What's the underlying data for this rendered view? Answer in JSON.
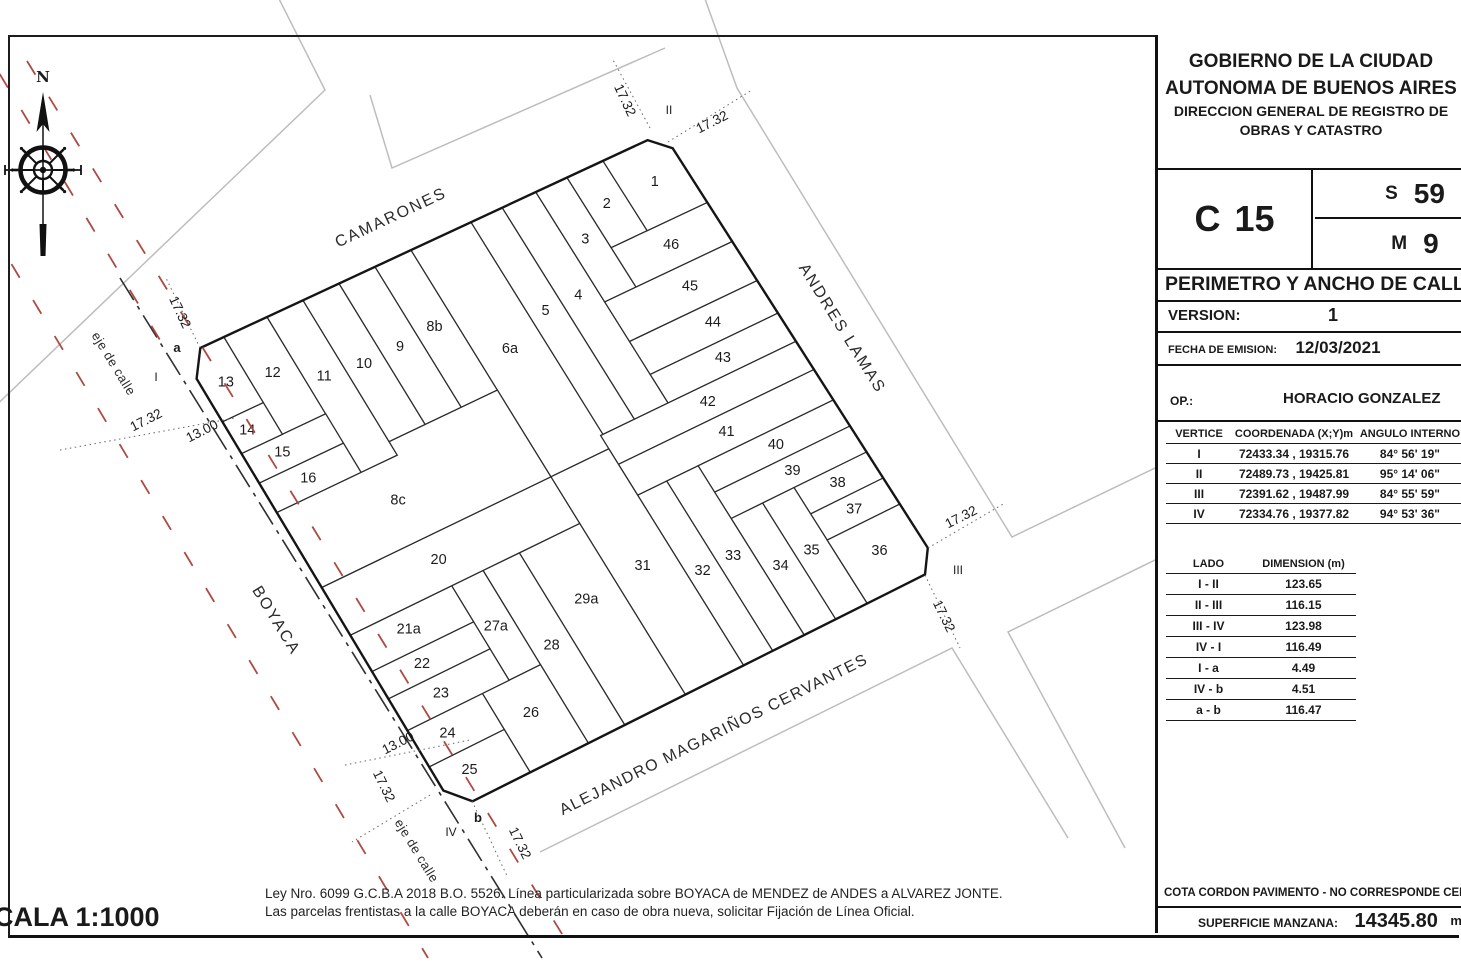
{
  "panel": {
    "header": [
      "GOBIERNO DE LA CIUDAD",
      "AUTONOMA DE BUENOS AIRES",
      "DIRECCION GENERAL DE REGISTRO DE",
      "OBRAS Y CATASTRO"
    ],
    "circunscripcion": {
      "letter": "C",
      "number": "15"
    },
    "seccion": {
      "letter": "S",
      "number": "59"
    },
    "manzana": {
      "letter": "M",
      "number": "9"
    },
    "title": "PERIMETRO Y ANCHO DE CALLE",
    "version_label": "VERSION:",
    "version_value": "1",
    "fecha_label": "FECHA DE EMISION:",
    "fecha_value": "12/03/2021",
    "op_label": "OP.:",
    "op_value": "HORACIO GONZALEZ",
    "vertex_table": {
      "headers": [
        "VERTICE",
        "COORDENADA (X;Y)m",
        "ANGULO INTERNO"
      ],
      "rows": [
        [
          "I",
          "72433.34 , 19315.76",
          "84° 56' 19\""
        ],
        [
          "II",
          "72489.73 , 19425.81",
          "95° 14' 06\""
        ],
        [
          "III",
          "72391.62 , 19487.99",
          "84° 55' 59\""
        ],
        [
          "IV",
          "72334.76 , 19377.82",
          "94° 53' 36\""
        ]
      ]
    },
    "lado_table": {
      "headers": [
        "LADO",
        "DIMENSION (m)"
      ],
      "rows": [
        [
          "I - II",
          "123.65"
        ],
        [
          "II - III",
          "116.15"
        ],
        [
          "III - IV",
          "123.98"
        ],
        [
          "IV - I",
          "116.49"
        ],
        [
          "I - a",
          "4.49"
        ],
        [
          "IV - b",
          "4.51"
        ],
        [
          "a - b",
          "116.47"
        ]
      ]
    },
    "cota_text": "COTA CORDON PAVIMENTO - NO CORRESPONDE CERTIFICAR NIVEL",
    "superficie_label": "SUPERFICIE MANZANA:",
    "superficie_value": "14345.80",
    "superficie_unit": "m²"
  },
  "footer": {
    "escala": "ESCALA 1:1000",
    "note_line1": "Ley Nro. 6099 G.C.B.A 2018 B.O. 5526. Línea particularizada sobre BOYACA de MENDEZ de ANDES a ALVAREZ JONTE.",
    "note_line2": "Las parcelas frentistas a la calle BOYACA deberán en caso de obra nueva, solicitar Fijación de Línea Oficial."
  },
  "map": {
    "colors": {
      "line": "#2b2b2b",
      "outline": "#151515",
      "neighbor": "#bdbdbd",
      "red": "#ad4a42",
      "axis": "#2f2f2f",
      "leader": "#666",
      "text": "#1c1c1c"
    },
    "corners": {
      "I": [
        183,
        356
      ],
      "II": [
        663,
        133
      ],
      "III": [
        940,
        567
      ],
      "IV": [
        455,
        810
      ]
    },
    "block_outline": [
      [
        0.036,
        0
      ],
      [
        0.968,
        0
      ],
      [
        1,
        0.035
      ],
      [
        1,
        0.956
      ],
      [
        0.969,
        1
      ],
      [
        0.036,
        1
      ],
      [
        0,
        0.957
      ],
      [
        0,
        0.05
      ]
    ],
    "parcel_rects": [
      [
        "12",
        0.085,
        0.175,
        0,
        0.215,
        0.13,
        0.1
      ],
      [
        "11",
        0.175,
        0.25,
        0,
        0.345,
        0.21,
        0.148
      ],
      [
        "10",
        0.25,
        0.325,
        0,
        0.315,
        0.287,
        0.158
      ],
      [
        "9",
        0.325,
        0.4,
        0,
        0.315,
        0.362,
        0.158
      ],
      [
        "8b",
        0.4,
        0.475,
        0,
        0.315,
        0.437,
        0.152
      ],
      [
        "6a",
        0.475,
        0.6,
        0,
        0.51,
        0.537,
        0.252
      ],
      [
        "5",
        0.6,
        0.665,
        0,
        0.48,
        0.632,
        0.215
      ],
      [
        "4",
        0.665,
        0.735,
        0,
        0.48,
        0.7,
        0.215
      ],
      [
        "3",
        0.735,
        0.8,
        0,
        0.25,
        0.768,
        0.122
      ],
      [
        "2",
        0.8,
        0.875,
        0,
        0.16,
        0.838,
        0.078
      ],
      [
        "46",
        0.8,
        1,
        0.16,
        0.25,
        0.9,
        0.203
      ],
      [
        "45",
        0.735,
        1,
        0.25,
        0.34,
        0.888,
        0.292
      ],
      [
        "44",
        0.735,
        1,
        0.34,
        0.415,
        0.888,
        0.375
      ],
      [
        "43",
        0.735,
        1,
        0.415,
        0.48,
        0.868,
        0.446
      ],
      [
        "42",
        0.595,
        1,
        0.48,
        0.545,
        0.8,
        0.51
      ],
      [
        "41",
        0.595,
        1,
        0.545,
        0.615,
        0.8,
        0.578
      ],
      [
        "40",
        0.72,
        1,
        0.615,
        0.675,
        0.865,
        0.643
      ],
      [
        "39",
        0.72,
        1,
        0.675,
        0.735,
        0.865,
        0.703
      ],
      [
        "38",
        0.85,
        1,
        0.735,
        0.795,
        0.924,
        0.763
      ],
      [
        "37",
        0.85,
        1,
        0.795,
        0.855,
        0.924,
        0.823
      ],
      [
        "35",
        0.785,
        0.85,
        0.735,
        1,
        0.816,
        0.858
      ],
      [
        "34",
        0.72,
        0.785,
        0.735,
        1,
        0.752,
        0.858
      ],
      [
        "33",
        0.655,
        0.72,
        0.615,
        1,
        0.687,
        0.8
      ],
      [
        "32",
        0.595,
        0.655,
        0.615,
        1,
        0.624,
        0.8
      ],
      [
        "31",
        0.475,
        0.595,
        0.51,
        1,
        0.534,
        0.74
      ],
      [
        "29a",
        0.35,
        0.475,
        0.615,
        1,
        0.412,
        0.75
      ],
      [
        "28",
        0.275,
        0.35,
        0.615,
        1,
        0.312,
        0.8
      ],
      [
        "27a",
        0.21,
        0.275,
        0.615,
        0.825,
        0.242,
        0.72
      ],
      [
        "26",
        0.155,
        0.275,
        0.825,
        1,
        0.214,
        0.898
      ],
      [
        "24",
        0,
        0.155,
        0.825,
        0.905,
        0.062,
        0.862
      ],
      [
        "23",
        0,
        0.21,
        0.755,
        0.825,
        0.09,
        0.788
      ],
      [
        "22",
        0,
        0.21,
        0.695,
        0.755,
        0.088,
        0.722
      ],
      [
        "21a",
        0,
        0.21,
        0.615,
        0.695,
        0.1,
        0.652
      ],
      [
        "20",
        0,
        0.475,
        0.51,
        0.615,
        0.215,
        0.558
      ],
      [
        "16",
        0,
        0.175,
        0.28,
        0.345,
        0.085,
        0.31
      ],
      [
        "15",
        0,
        0.175,
        0.215,
        0.28,
        0.068,
        0.245
      ],
      [
        "14",
        0,
        0.085,
        0.145,
        0.215,
        0.033,
        0.178
      ]
    ],
    "parcel_polys": [
      [
        "13",
        [
          [
            0,
            0.05
          ],
          [
            0.036,
            0
          ],
          [
            0.085,
            0
          ],
          [
            0.085,
            0.145
          ],
          [
            0,
            0.145
          ]
        ],
        0.045,
        0.078
      ],
      [
        "1",
        [
          [
            0.875,
            0
          ],
          [
            0.968,
            0
          ],
          [
            1,
            0.035
          ],
          [
            1,
            0.16
          ],
          [
            0.875,
            0.16
          ]
        ],
        0.938,
        0.078
      ],
      [
        "36",
        [
          [
            0.85,
            0.855
          ],
          [
            1,
            0.855
          ],
          [
            1,
            0.956
          ],
          [
            0.969,
            1
          ],
          [
            0.85,
            1
          ]
        ],
        0.922,
        0.918
      ],
      [
        "25",
        [
          [
            0,
            0.905
          ],
          [
            0.155,
            0.905
          ],
          [
            0.155,
            1
          ],
          [
            0.036,
            1
          ],
          [
            0,
            0.957
          ]
        ],
        0.062,
        0.943
      ],
      [
        "8c",
        [
          [
            0,
            0.345
          ],
          [
            0.25,
            0.345
          ],
          [
            0.25,
            0.315
          ],
          [
            0.475,
            0.315
          ],
          [
            0.475,
            0.51
          ],
          [
            0,
            0.51
          ]
        ],
        0.208,
        0.422
      ]
    ],
    "streets": [
      [
        "CAMARONES",
        393,
        222,
        -25,
        16,
        2
      ],
      [
        "ANDRES LAMAS",
        838,
        331,
        58,
        16,
        2
      ],
      [
        "ALEJANDRO MAGARIÑOS CERVANTES",
        716,
        739,
        -26.5,
        16,
        1.5
      ],
      [
        "BOYACA",
        272,
        623,
        58.5,
        16,
        2
      ],
      [
        "eje de calle",
        110,
        366,
        58.5,
        13,
        0.5
      ],
      [
        "eje de calle",
        413,
        853,
        58.5,
        13,
        0.5
      ]
    ],
    "dims": [
      [
        "17.32",
        176,
        314,
        65
      ],
      [
        "17.32",
        148,
        424,
        -27
      ],
      [
        "13.00",
        204,
        435,
        -27
      ],
      [
        "17.32",
        621,
        102,
        65
      ],
      [
        "17.32",
        714,
        126,
        -27
      ],
      [
        "17.32",
        963,
        521,
        -27
      ],
      [
        "17.32",
        940,
        618,
        64
      ],
      [
        "17.32",
        380,
        788,
        64
      ],
      [
        "13.00",
        400,
        747,
        -27
      ],
      [
        "17.32",
        516,
        845,
        64
      ]
    ],
    "leaders": [
      [
        200,
        348,
        166,
        278
      ],
      [
        60,
        450,
        235,
        418
      ],
      [
        650,
        128,
        612,
        58
      ],
      [
        668,
        142,
        752,
        90
      ],
      [
        928,
        548,
        1005,
        503
      ],
      [
        925,
        575,
        960,
        648
      ],
      [
        430,
        795,
        352,
        842
      ],
      [
        345,
        765,
        470,
        740
      ],
      [
        472,
        801,
        508,
        878
      ]
    ],
    "vertices": [
      [
        "a",
        177,
        352,
        1
      ],
      [
        "I",
        156,
        381,
        0
      ],
      [
        "II",
        669,
        114,
        0
      ],
      [
        "III",
        958,
        574,
        0
      ],
      [
        "IV",
        451,
        836,
        0
      ],
      [
        "b",
        478,
        822,
        1
      ]
    ],
    "red_lines": [
      [
        27,
        61,
        570,
        947
      ],
      [
        -75,
        120,
        428,
        958
      ],
      [
        -22,
        38,
        160,
        340
      ]
    ],
    "axis_lines": [
      [
        120,
        278,
        542,
        958
      ]
    ],
    "neighbor_lines": [
      [
        [
          -40,
          440
        ],
        [
          325,
          90
        ],
        [
          272,
          -15
        ]
      ],
      [
        [
          370,
          95
        ],
        [
          392,
          168
        ],
        [
          665,
          48
        ]
      ],
      [
        [
          700,
          -15
        ],
        [
          737,
          88
        ],
        [
          1012,
          537
        ],
        [
          1155,
          468
        ]
      ],
      [
        [
          1155,
          560
        ],
        [
          1008,
          632
        ],
        [
          1125,
          848
        ]
      ],
      [
        [
          540,
          852
        ],
        [
          952,
          648
        ],
        [
          1068,
          838
        ]
      ]
    ],
    "compass": {
      "cx": 43,
      "cy": 170,
      "label": "N"
    }
  }
}
